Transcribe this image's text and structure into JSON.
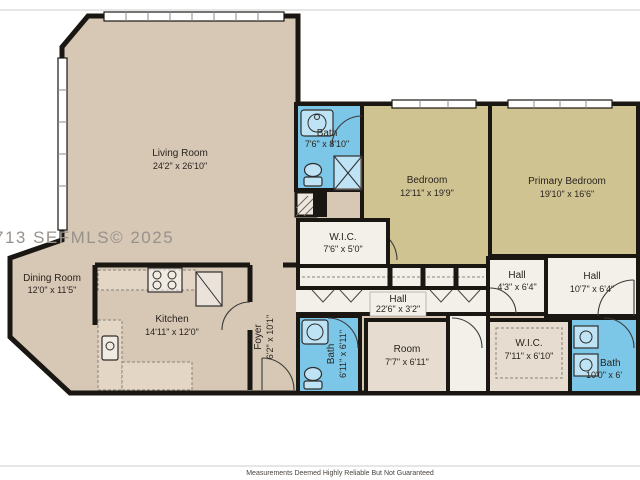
{
  "watermark": "713 SEFMLS© 2025",
  "disclaimer": "Measurements Deemed Highly Reliable But Not Guaranteed",
  "colors": {
    "room_tan": "#d7c7b5",
    "bedroom_khaki": "#cfc392",
    "bath_blue": "#7cc7e8",
    "hall_white": "#f3f0ea",
    "closet_cream": "#e6ddd0",
    "wall_black": "#1a1712"
  },
  "rooms": {
    "living": {
      "name": "Living Room",
      "dims": "24'2\" x 26'10\""
    },
    "dining": {
      "name": "Dining Room",
      "dims": "12'0\" x 11'5\""
    },
    "kitchen": {
      "name": "Kitchen",
      "dims": "14'11\" x 12'0\""
    },
    "foyer": {
      "name": "Foyer",
      "dims": "6'2\" x 10'1\""
    },
    "bath_top": {
      "name": "Bath",
      "dims": "7'6\" x 8'10\""
    },
    "wic_top": {
      "name": "W.I.C.",
      "dims": "7'6\" x 5'0\""
    },
    "bedroom": {
      "name": "Bedroom",
      "dims": "12'11\" x 19'9\""
    },
    "primary": {
      "name": "Primary Bedroom",
      "dims": "19'10\" x 16'6\""
    },
    "hall_main": {
      "name": "Hall",
      "dims": "22'6\" x 3'2\""
    },
    "hall_small": {
      "name": "Hall",
      "dims": "4'3\" x 6'4\""
    },
    "hall_right": {
      "name": "Hall",
      "dims": "10'7\" x 6'4\""
    },
    "bath_mid": {
      "name": "Bath",
      "dims": "6'11\" x 6'11\""
    },
    "room": {
      "name": "Room",
      "dims": "7'7\" x 6'11\""
    },
    "wic_bottom": {
      "name": "W.I.C.",
      "dims": "7'11\" x 6'10\""
    },
    "bath_right": {
      "name": "Bath",
      "dims": "10'0\" x 6'"
    }
  }
}
